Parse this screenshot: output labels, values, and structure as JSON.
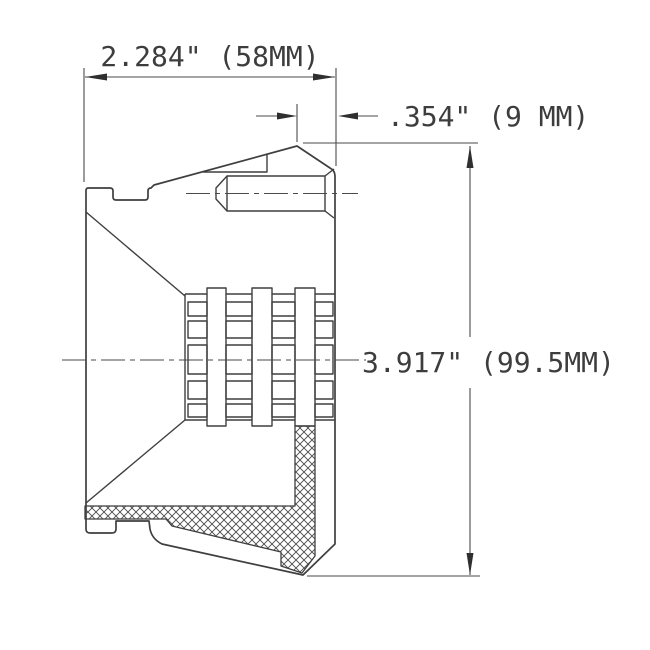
{
  "drawing": {
    "kind": "technical-drawing-cross-section",
    "background_color": "#ffffff",
    "line_color": "#3f3f3f",
    "dimensions": {
      "width": "2.284\" (58MM)",
      "depth": ".354\" (9 MM)",
      "height": "3.917\" (99.5MM)"
    }
  }
}
